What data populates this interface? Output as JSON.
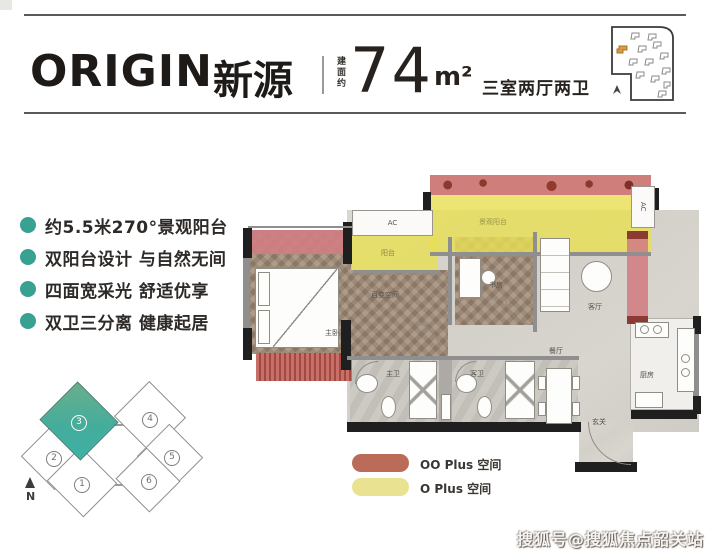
{
  "header": {
    "logo": "ORIGIN",
    "title_cn": "新源",
    "area_label": "建面约",
    "area_value": "74",
    "area_unit": "m²",
    "spec": "三室两厅两卫"
  },
  "features": [
    "约5.5米270°景观阳台",
    "双阳台设计 与自然无间",
    "四面宽采光 舒适优享",
    "双卫三分离 健康起居"
  ],
  "keyplan": {
    "north": "N",
    "units": [
      {
        "num": "1",
        "highlighted": false
      },
      {
        "num": "2",
        "highlighted": false
      },
      {
        "num": "3",
        "highlighted": true
      },
      {
        "num": "4",
        "highlighted": false
      },
      {
        "num": "5",
        "highlighted": false
      },
      {
        "num": "6",
        "highlighted": false
      }
    ]
  },
  "floorplan": {
    "rooms": {
      "master": "主卧",
      "flex": "百变空间",
      "study": "书房",
      "living": "客厅",
      "dining": "餐厅",
      "bath_master": "主卫",
      "bath_guest": "客卫",
      "kitchen": "厨房",
      "entry": "玄关",
      "balcony": "阳台",
      "view_balcony": "景观阳台",
      "ac1": "AC",
      "ac2": "AC"
    }
  },
  "legend": [
    {
      "label": "OO Plus 空间",
      "color": "#bb6c59"
    },
    {
      "label": "O Plus 空间",
      "color": "#e9e290"
    }
  ],
  "watermark": "搜狐号@搜狐焦点韶关站",
  "colors": {
    "accent_teal": "#38a192",
    "overlay_pink": "#d17e83",
    "overlay_yellow": "#e8df56",
    "header_text": "#1e1a17"
  }
}
